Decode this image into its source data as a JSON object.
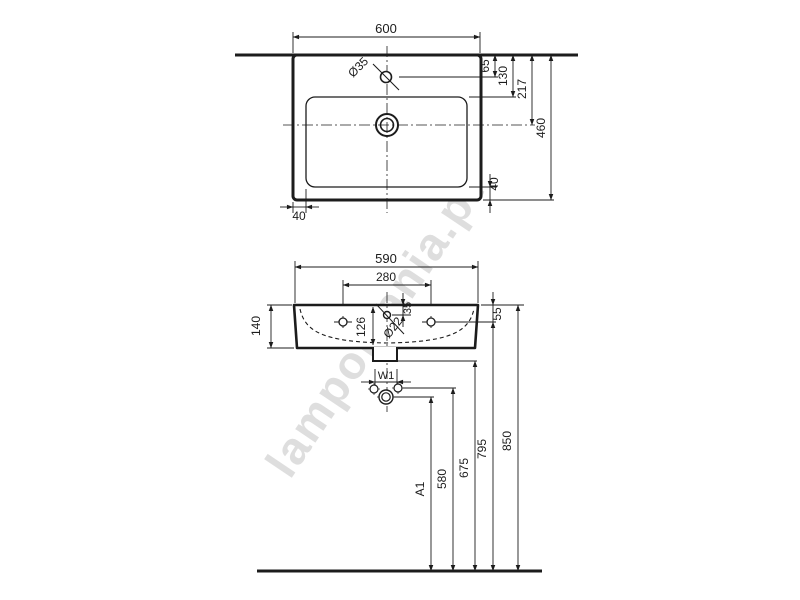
{
  "meta": {
    "background_color": "#ffffff",
    "line_color": "#1c1c1c",
    "watermark_color": "#c9c9c9",
    "drawing_type": "wall-hung washbasin installation drawing, two orthographic views with dimensions in mm"
  },
  "watermark": {
    "text": "lampomania.pt"
  },
  "top_view": {
    "overall_width": "600",
    "tap_hole_diameter": "Ø35",
    "tap_hole_to_wall": "65",
    "bowl_front_to_wall": "130",
    "drain_center_to_wall": "217",
    "overall_depth": "460",
    "rim_width_right": "40",
    "rim_width_left": "40"
  },
  "front_view": {
    "overall_width": "590",
    "fixing_hole_spacing": "280",
    "body_height": "140",
    "bowl_inner_depth": "126",
    "fixing_hole_diameter": "Ø22",
    "hole_below_rim": "35",
    "fixing_below_rim": "55",
    "outlet_width_label": "W1",
    "trap_height_label": "A1",
    "trap_side_height": "580",
    "outlet_bottom_height": "675",
    "fixing_hole_height": "795",
    "rim_height": "850"
  }
}
